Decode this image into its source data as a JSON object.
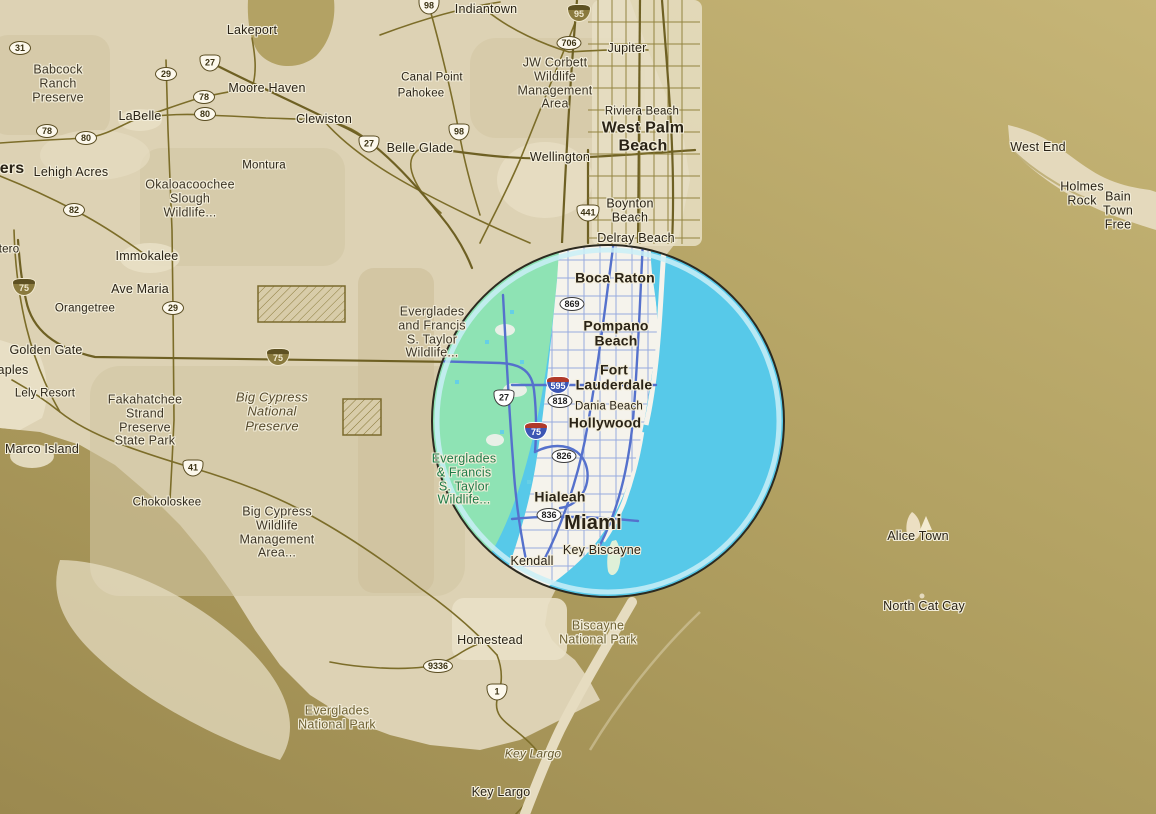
{
  "map": {
    "colors": {
      "ocean_gold": "#b3a263",
      "ocean_gold_light": "#c6b577",
      "gulf_gold_dark": "#9b894f",
      "land": "#ddd2b4",
      "land_dark": "#cfc3a0",
      "land_cream": "#e8dfc4",
      "road_olive": "#7c6d29",
      "overlay_water_cyan": "#57c9e9",
      "overlay_ring_light": "#c9eef7",
      "overlay_outline": "#2c2a20",
      "everglades_green": "#8ee3b4",
      "urban_white": "#f5f3ec",
      "road_blue": "#5571cc",
      "city_text": "#2a2316",
      "park_text_olive": "#6f6234",
      "park_text_green": "#1e7b47"
    },
    "overlay_circle": {
      "cx": 608,
      "cy": 421,
      "r": 176
    },
    "labels": [
      {
        "t": "Lakeport",
        "x": 252,
        "y": 31,
        "c": "city-sm"
      },
      {
        "t": "Babcock\nRanch\nPreserve",
        "x": 58,
        "y": 84,
        "c": "park-dark"
      },
      {
        "t": "Moore Haven",
        "x": 267,
        "y": 89,
        "c": "city-sm"
      },
      {
        "t": "LaBelle",
        "x": 140,
        "y": 117,
        "c": "city-sm"
      },
      {
        "t": "Clewiston",
        "x": 324,
        "y": 120,
        "c": "city-sm"
      },
      {
        "t": "Canal Point",
        "x": 432,
        "y": 78,
        "c": "city-xs"
      },
      {
        "t": "Pahokee",
        "x": 421,
        "y": 94,
        "c": "city-xs"
      },
      {
        "t": "Indiantown",
        "x": 486,
        "y": 10,
        "c": "city-sm"
      },
      {
        "t": "Jupiter",
        "x": 627,
        "y": 49,
        "c": "city-sm"
      },
      {
        "t": "JW Corbett\nWildlife\nManagement\nArea",
        "x": 555,
        "y": 84,
        "c": "park-dark"
      },
      {
        "t": "Riviera Beach",
        "x": 642,
        "y": 112,
        "c": "city-xs"
      },
      {
        "t": "West Palm\nBeach",
        "x": 643,
        "y": 137,
        "c": "city-lg"
      },
      {
        "t": "Wellington",
        "x": 560,
        "y": 158,
        "c": "city-sm"
      },
      {
        "t": "Boynton\nBeach",
        "x": 630,
        "y": 211,
        "c": "city-sm"
      },
      {
        "t": "Delray Beach",
        "x": 636,
        "y": 239,
        "c": "city-sm"
      },
      {
        "t": "Belle Glade",
        "x": 420,
        "y": 149,
        "c": "city-sm"
      },
      {
        "t": "Montura",
        "x": 264,
        "y": 166,
        "c": "city-xs"
      },
      {
        "t": "Okaloacoochee\nSlough\nWildlife...",
        "x": 190,
        "y": 199,
        "c": "park-dark"
      },
      {
        "t": "Lehigh Acres",
        "x": 71,
        "y": 173,
        "c": "city-sm"
      },
      {
        "t": "ers",
        "x": 12,
        "y": 169,
        "c": "city-lg-cut"
      },
      {
        "t": "tero",
        "x": 9,
        "y": 250,
        "c": "city-xs"
      },
      {
        "t": "aples",
        "x": 13,
        "y": 371,
        "c": "city-sm"
      },
      {
        "t": "Immokalee",
        "x": 147,
        "y": 257,
        "c": "city-sm"
      },
      {
        "t": "Ave Maria",
        "x": 140,
        "y": 290,
        "c": "city-sm"
      },
      {
        "t": "Orangetree",
        "x": 85,
        "y": 309,
        "c": "city-xs"
      },
      {
        "t": "Golden Gate",
        "x": 46,
        "y": 351,
        "c": "city-sm"
      },
      {
        "t": "Lely Resort",
        "x": 45,
        "y": 394,
        "c": "city-xs"
      },
      {
        "t": "Marco Island",
        "x": 42,
        "y": 450,
        "c": "city-sm"
      },
      {
        "t": "Fakahatchee\nStrand\nPreserve\nState Park",
        "x": 145,
        "y": 421,
        "c": "park-dark"
      },
      {
        "t": "Big Cypress\nNational\nPreserve",
        "x": 272,
        "y": 412,
        "c": "park-italic"
      },
      {
        "t": "Chokoloskee",
        "x": 167,
        "y": 503,
        "c": "city-xs"
      },
      {
        "t": "Big Cypress\nWildlife\nManagement\nArea...",
        "x": 277,
        "y": 533,
        "c": "park-dark"
      },
      {
        "t": "Everglades\nand Francis\nS. Taylor\nWildlife...",
        "x": 432,
        "y": 333,
        "c": "park-dark"
      },
      {
        "t": "Everglades\n& Francis\nS. Taylor\nWildlife...",
        "x": 464,
        "y": 480,
        "c": "park-green"
      },
      {
        "t": "Boca Raton",
        "x": 615,
        "y": 278,
        "c": "city-md"
      },
      {
        "t": "Pompano\nBeach",
        "x": 616,
        "y": 334,
        "c": "city-md"
      },
      {
        "t": "Fort\nLauderdale",
        "x": 614,
        "y": 378,
        "c": "city-md"
      },
      {
        "t": "Dania Beach",
        "x": 609,
        "y": 407,
        "c": "city-xs"
      },
      {
        "t": "Hollywood",
        "x": 605,
        "y": 423,
        "c": "city-md"
      },
      {
        "t": "Hialeah",
        "x": 560,
        "y": 497,
        "c": "city-md"
      },
      {
        "t": "Miami",
        "x": 593,
        "y": 523,
        "c": "city-xl"
      },
      {
        "t": "Key Biscayne",
        "x": 602,
        "y": 551,
        "c": "city-sm"
      },
      {
        "t": "Kendall",
        "x": 532,
        "y": 562,
        "c": "city-sm"
      },
      {
        "t": "Homestead",
        "x": 490,
        "y": 641,
        "c": "city-sm"
      },
      {
        "t": "Biscayne\nNational Park",
        "x": 598,
        "y": 633,
        "c": "park-olive"
      },
      {
        "t": "Everglades\nNational Park",
        "x": 337,
        "y": 718,
        "c": "park-olive"
      },
      {
        "t": "Key Largo",
        "x": 533,
        "y": 754,
        "c": "key-italic"
      },
      {
        "t": "Key Largo",
        "x": 501,
        "y": 793,
        "c": "city-sm"
      },
      {
        "t": "West End",
        "x": 1038,
        "y": 148,
        "c": "city-sm"
      },
      {
        "t": "Holmes Rock",
        "x": 1082,
        "y": 194,
        "c": "city-sm"
      },
      {
        "t": "Bain Town  Free",
        "x": 1118,
        "y": 211,
        "c": "city-sm"
      },
      {
        "t": "Alice Town",
        "x": 918,
        "y": 537,
        "c": "city-sm"
      },
      {
        "t": "North Cat Cay",
        "x": 924,
        "y": 607,
        "c": "city-sm"
      }
    ],
    "shields": [
      {
        "n": "31",
        "k": "oval",
        "x": 20,
        "y": 48
      },
      {
        "n": "29",
        "k": "oval",
        "x": 166,
        "y": 74
      },
      {
        "n": "27",
        "k": "us",
        "x": 210,
        "y": 63
      },
      {
        "n": "78",
        "k": "oval",
        "x": 204,
        "y": 97
      },
      {
        "n": "80",
        "k": "oval",
        "x": 205,
        "y": 114
      },
      {
        "n": "78",
        "k": "oval",
        "x": 47,
        "y": 131
      },
      {
        "n": "80",
        "k": "oval",
        "x": 86,
        "y": 138
      },
      {
        "n": "82",
        "k": "oval",
        "x": 74,
        "y": 210
      },
      {
        "n": "27",
        "k": "us",
        "x": 369,
        "y": 144
      },
      {
        "n": "98",
        "k": "us",
        "x": 429,
        "y": 6
      },
      {
        "n": "98",
        "k": "us",
        "x": 459,
        "y": 132
      },
      {
        "n": "441",
        "k": "us",
        "x": 588,
        "y": 213
      },
      {
        "n": "706",
        "k": "oval",
        "x": 569,
        "y": 43
      },
      {
        "n": "95",
        "k": "i-sepia",
        "x": 579,
        "y": 13
      },
      {
        "n": "75",
        "k": "i-sepia",
        "x": 24,
        "y": 287
      },
      {
        "n": "75",
        "k": "i-sepia",
        "x": 278,
        "y": 357
      },
      {
        "n": "29",
        "k": "oval",
        "x": 173,
        "y": 308
      },
      {
        "n": "41",
        "k": "us",
        "x": 193,
        "y": 468
      },
      {
        "n": "869",
        "k": "oval-w",
        "x": 572,
        "y": 304
      },
      {
        "n": "595",
        "k": "i-blue",
        "x": 558,
        "y": 385
      },
      {
        "n": "818",
        "k": "oval-w",
        "x": 560,
        "y": 401
      },
      {
        "n": "27",
        "k": "us-w",
        "x": 504,
        "y": 398
      },
      {
        "n": "75",
        "k": "i-blue",
        "x": 536,
        "y": 431
      },
      {
        "n": "826",
        "k": "oval-w",
        "x": 564,
        "y": 456
      },
      {
        "n": "836",
        "k": "oval-w",
        "x": 549,
        "y": 515
      },
      {
        "n": "9336",
        "k": "oval",
        "x": 438,
        "y": 666
      },
      {
        "n": "1",
        "k": "us",
        "x": 497,
        "y": 692
      }
    ]
  }
}
